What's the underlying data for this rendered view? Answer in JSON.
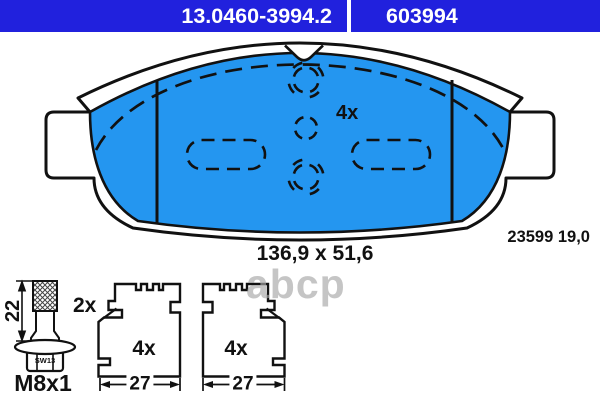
{
  "header": {
    "part_number": "13.0460-3994.2",
    "oe_number": "603994"
  },
  "pad_drawing": {
    "qty_label": "4x",
    "dimensions_label": "136,9 x 51,6",
    "wva_label": "23599 19,0"
  },
  "bolt_drawing": {
    "qty_label": "2x",
    "length_label": "22",
    "thread_label": "M8x1",
    "wrench_label": "SW13"
  },
  "clip_left": {
    "qty_label": "4x",
    "width_label": "27"
  },
  "clip_right": {
    "qty_label": "4x",
    "width_label": "27"
  },
  "watermark": {
    "text": "abcp"
  },
  "colors": {
    "header_bg": "#2121dd",
    "pad_fill": "#2496f0",
    "line": "#111111",
    "watermark": "#a8a8a8"
  }
}
